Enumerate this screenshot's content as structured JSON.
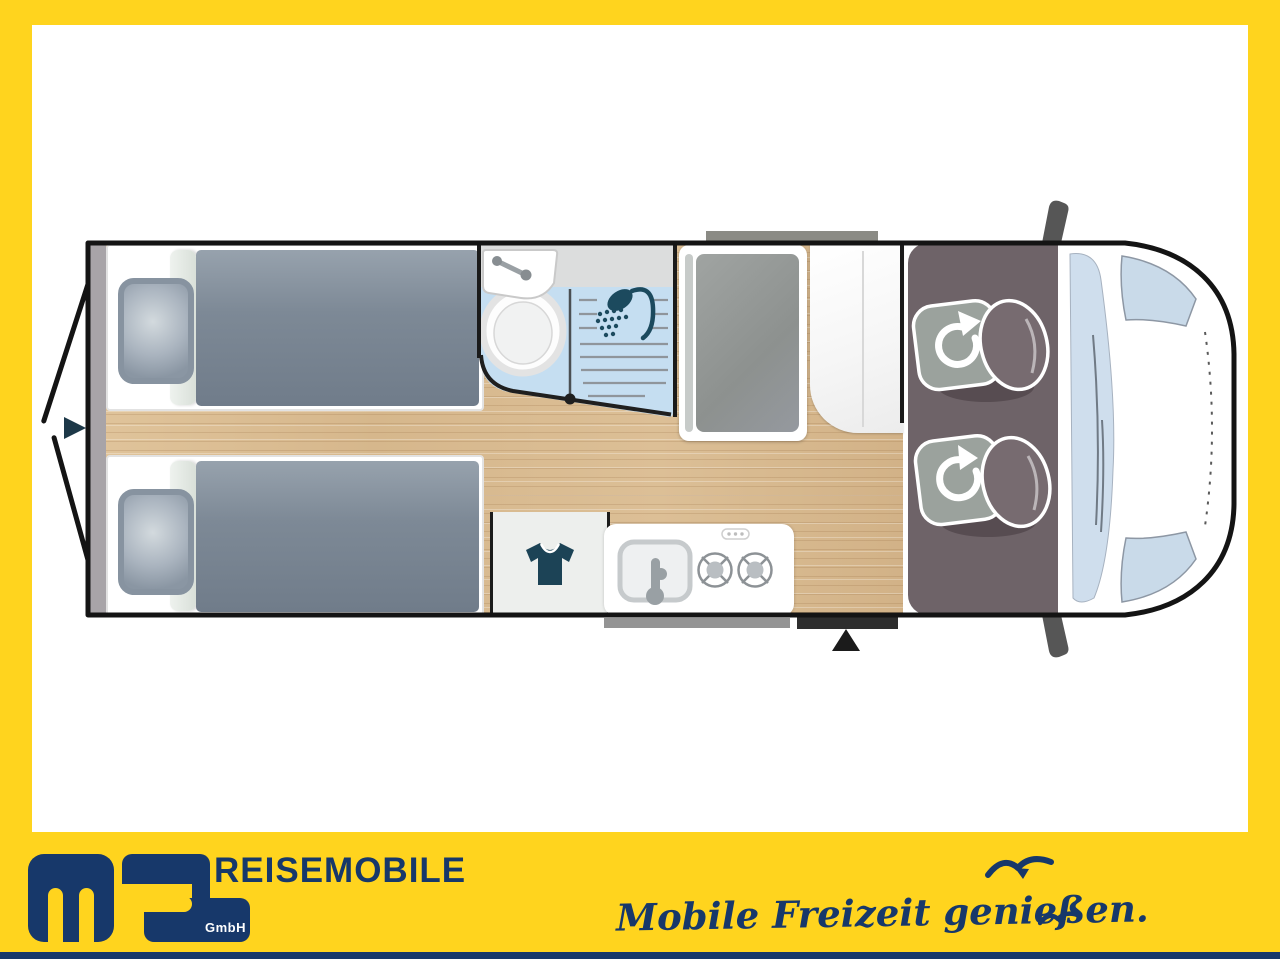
{
  "branding": {
    "logo": {
      "letters": "ms",
      "suffix": "GmbH"
    },
    "company_name": "REISEMOBILE",
    "tagline": "Mobile Freizeit genießen.",
    "colors": {
      "brand_yellow": "#FFD41E",
      "brand_navy": "#17386A"
    }
  },
  "floorplan": {
    "view": "motorhome top-view layout drawing, no text labels",
    "zones": {
      "rear": "two single beds with pillows and grey duvets",
      "washroom": "washbasin, toilet and shower with sliding door",
      "tall_cabinet": "wardrobe / fridge cabinet",
      "clothes_cabinet": "cabinet with t-shirt symbol",
      "kitchen": "kitchen block with sink and two-burner hob",
      "entry": "entrance door with step marker",
      "cab": "driver cab with two swivel seats, windshield and mirrors"
    },
    "icons": {
      "rear_arrow": "rear-entry-arrow-icon",
      "entry_arrow": "entry-arrow-icon",
      "shower": "shower-head-icon",
      "toilet": "toilet-icon",
      "washbasin": "washbasin-icon",
      "tshirt": "t-shirt-icon",
      "hob": "two-burner-hob-icon",
      "kitchen_sink": "kitchen-sink-icon",
      "swivel_seats": "swivel-seat-rotate-icon",
      "mirrors": "side-mirror-icon",
      "birds": "seagull-icon"
    },
    "colors": {
      "wood_floor": "#DBBE94",
      "bathroom_floor": "#C5DEF1",
      "duvet": "#76818F",
      "cab_floor": "#6E6368",
      "seat_base": "#9BA29D",
      "seat_backrest": "#776B70",
      "windshield": "#CFDEED",
      "icon_navy": "#1C4356",
      "outline": "#141414"
    }
  }
}
